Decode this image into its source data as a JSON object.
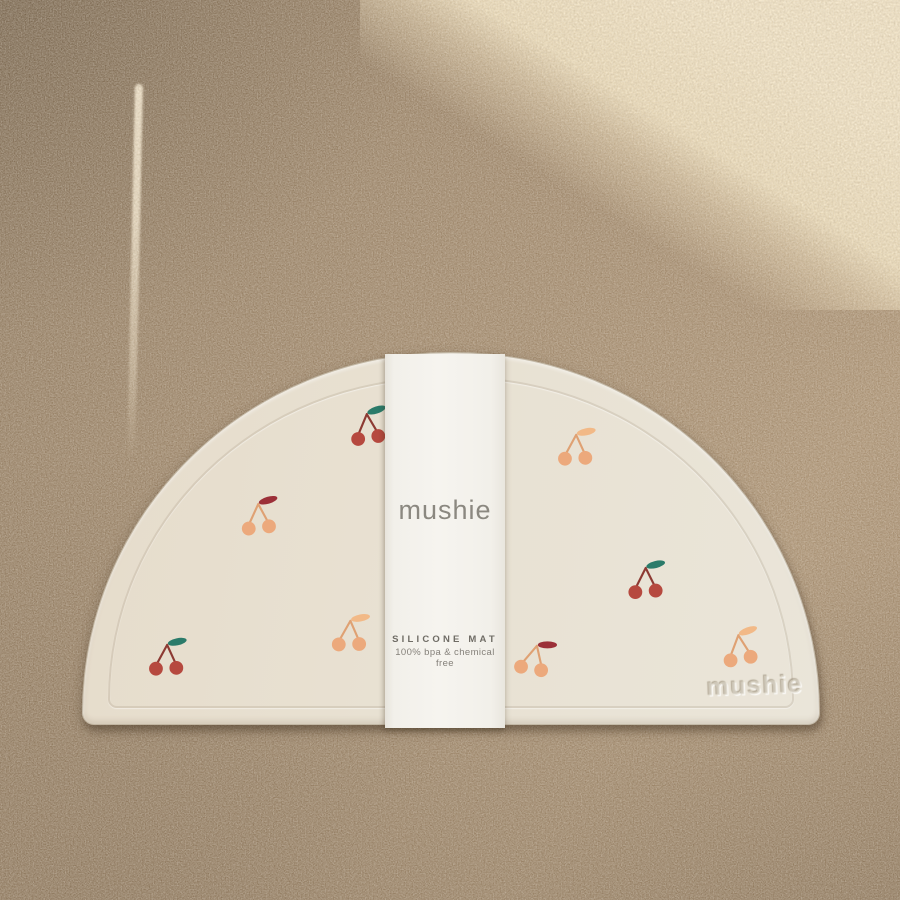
{
  "band": {
    "brand": "mushie",
    "product_label": "SILICONE MAT",
    "tagline": "100% bpa & chemical free"
  },
  "mat": {
    "embossed_brand": "mushie",
    "shape": "semicircle",
    "pattern": "cherries"
  },
  "colors": {
    "background_dark": "#877157",
    "background_mid": "#9c8366",
    "background_warm": "#a98f70",
    "sunlight": "#ecdcba",
    "mat_surface": "#e8e1d2",
    "band_paper": "#f6f4ef",
    "cherry_red": "#b6493f",
    "cherry_stem_red": "#8d3a33",
    "leaf_teal": "#2b7b6a",
    "cherry_peach": "#eca97c",
    "cherry_stem_peach": "#dfa173",
    "leaf_peach": "#f2b987",
    "leaf_dark_red": "#9c3038"
  },
  "cherries": {
    "variants": {
      "red_teal": {
        "cherry": "#b6493f",
        "stem": "#8d3a33",
        "leaf": "#2b7b6a"
      },
      "peach_peach": {
        "cherry": "#eca97c",
        "stem": "#dfa173",
        "leaf": "#f2b987"
      },
      "peach_darkred": {
        "cherry": "#eca97c",
        "stem": "#dfa173",
        "leaf": "#9c3038"
      }
    },
    "instances": [
      {
        "x": 347,
        "y": 404,
        "variant": "red_teal",
        "rotate": -4
      },
      {
        "x": 555,
        "y": 425,
        "variant": "peach_peach",
        "rotate": 2
      },
      {
        "x": 238,
        "y": 494,
        "variant": "peach_darkred",
        "rotate": -2
      },
      {
        "x": 625,
        "y": 558,
        "variant": "red_teal",
        "rotate": 0
      },
      {
        "x": 329,
        "y": 611,
        "variant": "peach_peach",
        "rotate": 3
      },
      {
        "x": 146,
        "y": 635,
        "variant": "red_teal",
        "rotate": 2
      },
      {
        "x": 513,
        "y": 636,
        "variant": "peach_darkred",
        "rotate": 14
      },
      {
        "x": 719,
        "y": 625,
        "variant": "peach_peach",
        "rotate": -6
      }
    ]
  }
}
